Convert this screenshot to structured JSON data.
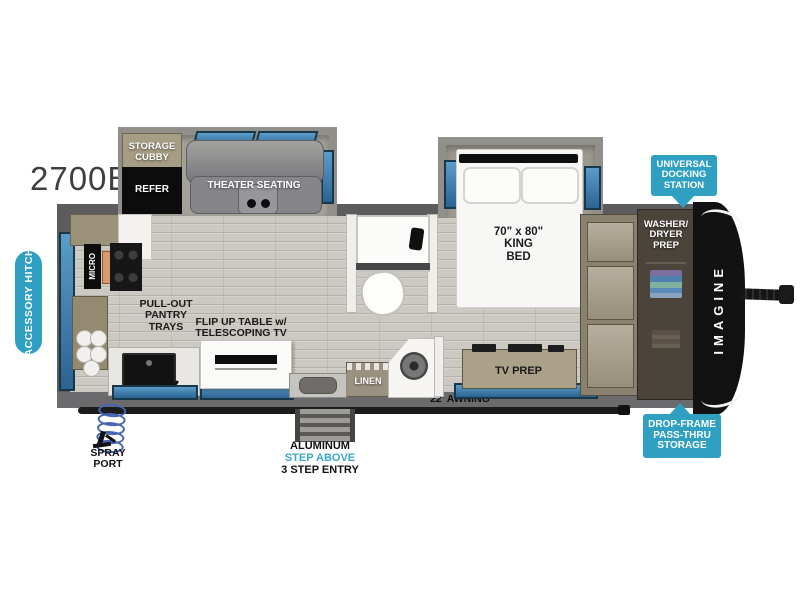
{
  "model": "2700BS",
  "colors": {
    "badge_teal": "#2F9FC2",
    "step_above_teal": "#3AA6C6",
    "window_blue": "#3A79AC",
    "wall_gray": "#5C5C5E",
    "cabinet_tan": "#A59C86"
  },
  "badges": {
    "accessory_hitch": "ACCESSORY HITCH",
    "universal_docking": "UNIVERSAL\nDOCKING\nSTATION",
    "drop_frame": "DROP-FRAME\nPASS-THRU\nSTORAGE"
  },
  "rooms": {
    "storage_cubby": "STORAGE\nCUBBY",
    "refer": "REFER",
    "theater_seating": "THEATER SEATING",
    "king_bed": "70\" x 80\"\nKING\nBED",
    "washer_dryer_prep": "WASHER/\nDRYER\nPREP",
    "micro": "MICRO",
    "pullout_pantry": "PULL-OUT\nPANTRY\nTRAYS",
    "flip_up_table": "FLIP UP TABLE w/\nTELESCOPING TV",
    "linen": "LINEN",
    "tv_prep": "TV PREP"
  },
  "exterior": {
    "awning": "22' AWNING",
    "entry_material": "ALUMINUM",
    "entry_step_above": "STEP ABOVE",
    "entry_steps": "3 STEP ENTRY",
    "spray_port": "SPRAY\nPORT",
    "brand": "IMAGINE"
  }
}
